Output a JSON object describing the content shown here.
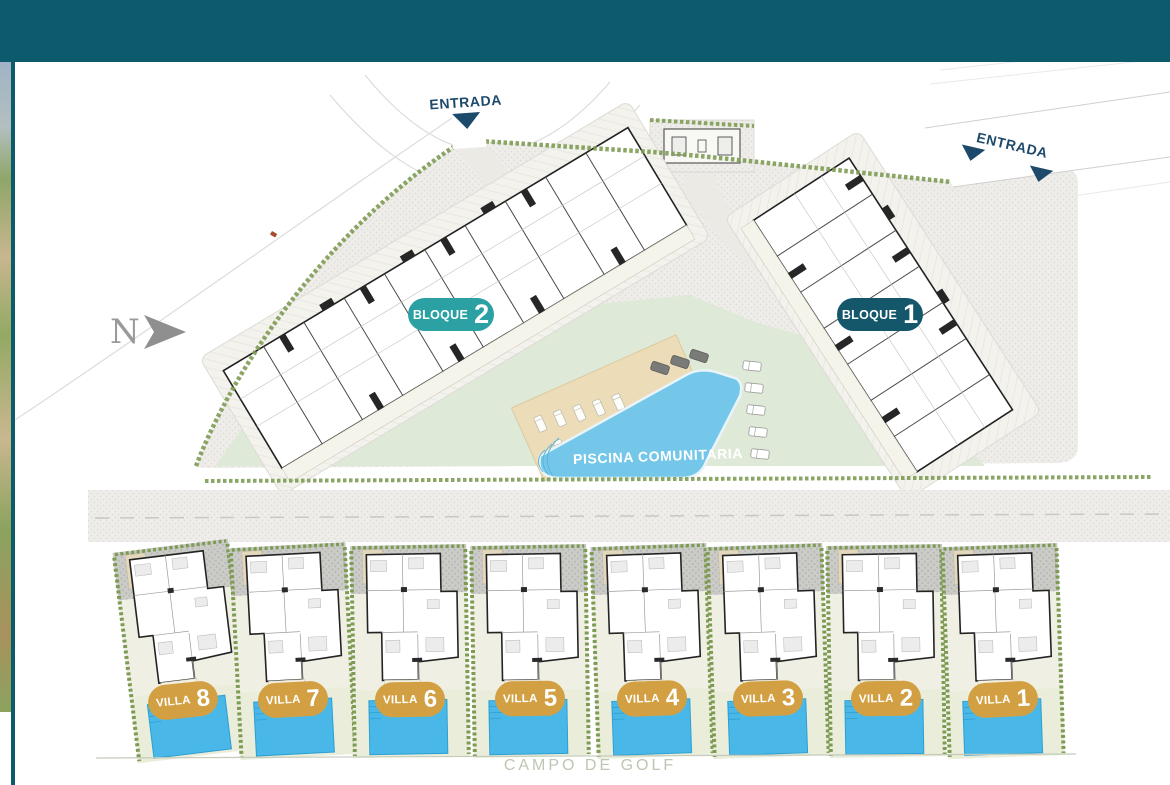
{
  "plan": {
    "north": {
      "label": "N"
    },
    "entrances": [
      {
        "label": "ENTRADA"
      },
      {
        "label": "ENTRADA"
      }
    ],
    "blocks": [
      {
        "label": "BLOQUE",
        "number": "2",
        "color": "#2ba1a4"
      },
      {
        "label": "BLOQUE",
        "number": "1",
        "color": "#14576b"
      }
    ],
    "community_pool": {
      "label": "PISCINA COMUNITARIA",
      "color": "#74c7e9"
    },
    "villas": [
      {
        "label": "VILLA",
        "number": "8",
        "color": "#d2a042"
      },
      {
        "label": "VILLA",
        "number": "7",
        "color": "#d2a042"
      },
      {
        "label": "VILLA",
        "number": "6",
        "color": "#d2a042"
      },
      {
        "label": "VILLA",
        "number": "5",
        "color": "#d2a042"
      },
      {
        "label": "VILLA",
        "number": "4",
        "color": "#d2a042"
      },
      {
        "label": "VILLA",
        "number": "3",
        "color": "#d2a042"
      },
      {
        "label": "VILLA",
        "number": "2",
        "color": "#d2a042"
      },
      {
        "label": "VILLA",
        "number": "1",
        "color": "#d2a042"
      }
    ],
    "surroundings": {
      "golf_label": "CAMPO DE GOLF"
    },
    "theme": {
      "header_color": "#0b5b6c",
      "arrow_color": "#1d4a6b",
      "hedge_color": "#7e9b54",
      "lawn_color": "#dfe9d8",
      "villa_pool_color": "#49b8e8"
    }
  }
}
